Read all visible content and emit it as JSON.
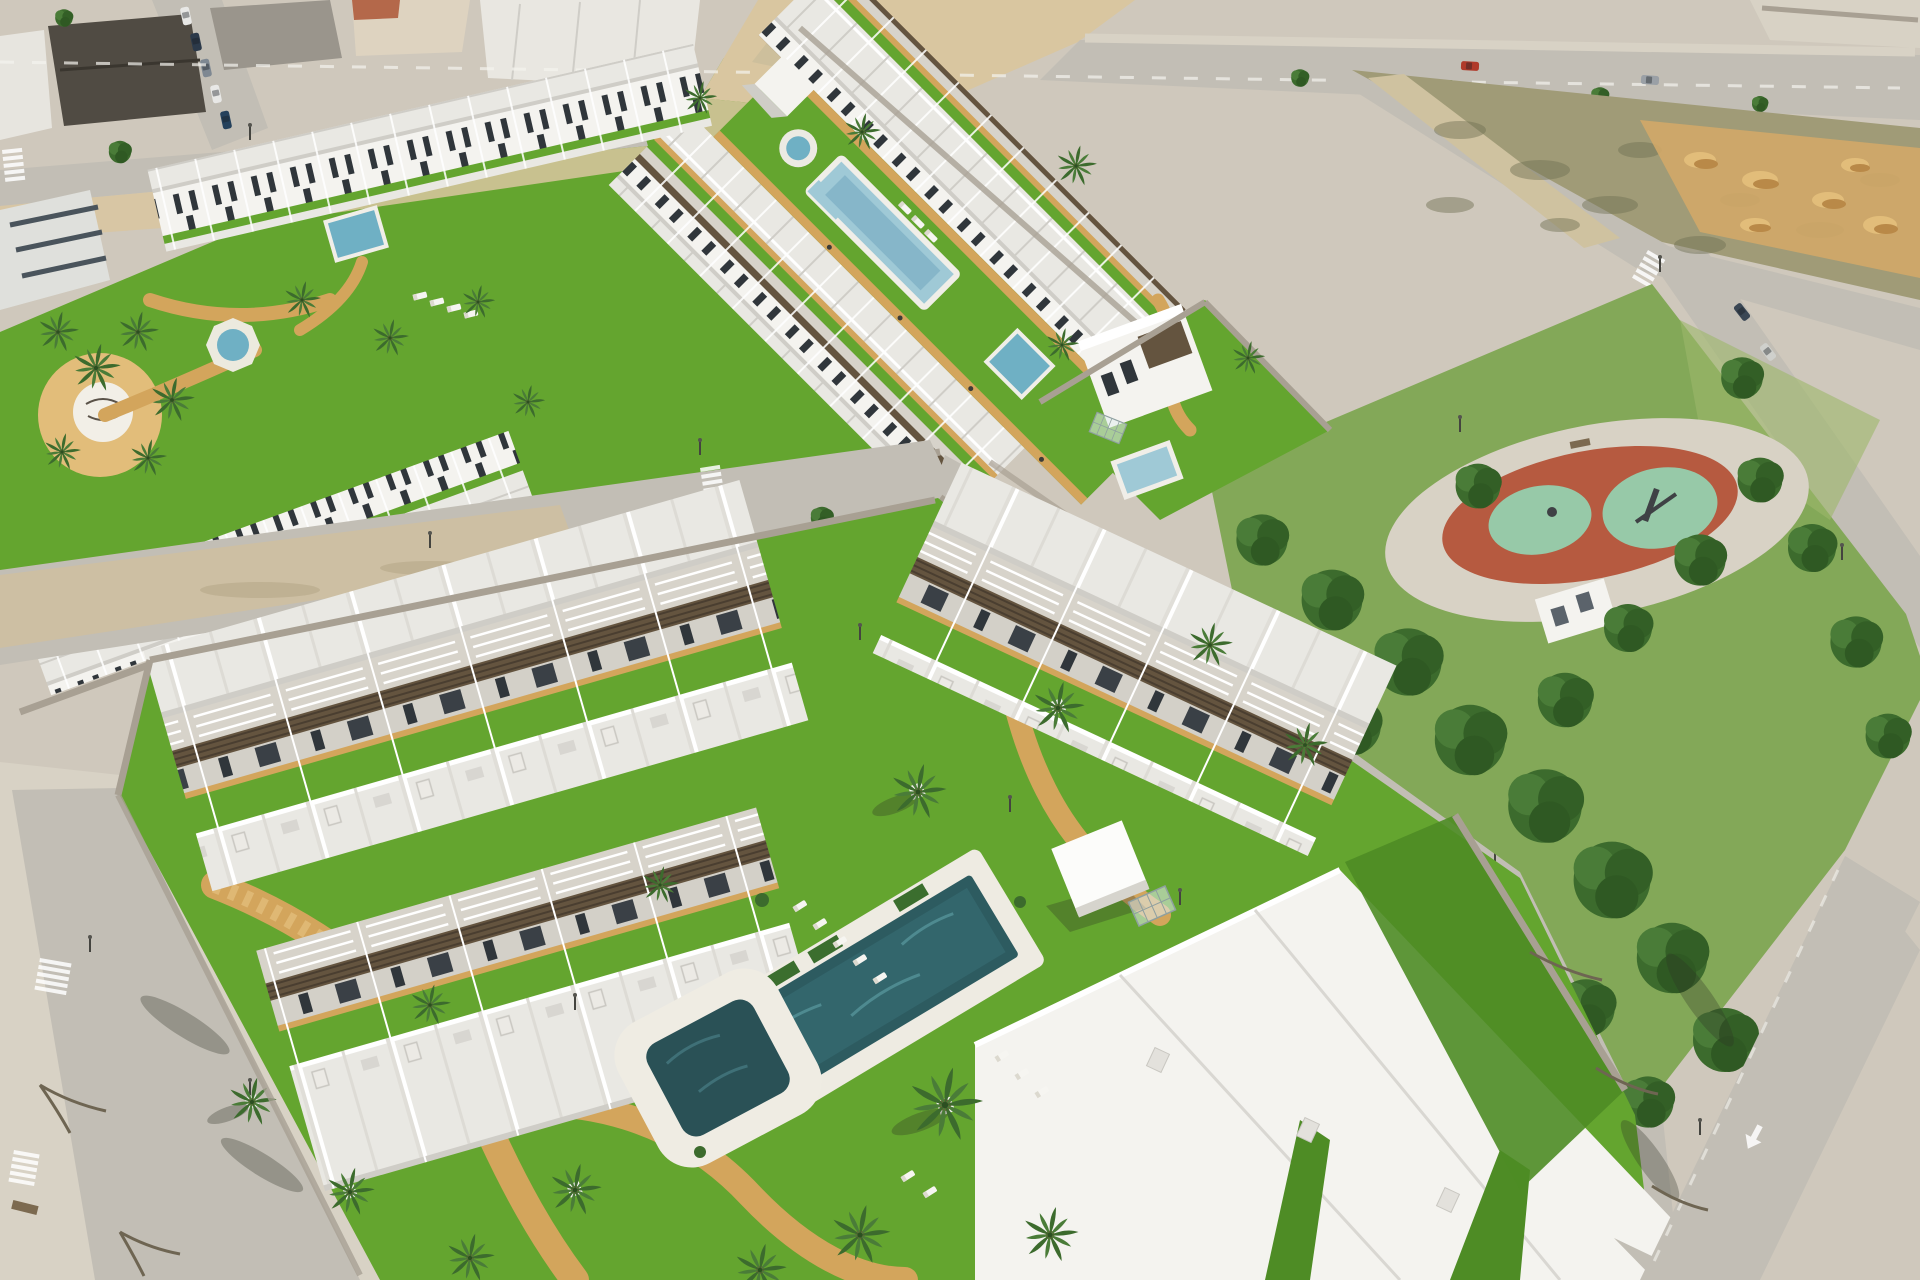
{
  "meta": {
    "description": "Aerial 3D render of a new coastal residential development: rows of white flat-roofed townhouses with wooden pergolas around landscaped courtyards with swimming pools and palm trees, an older urban block with parked cars at the top left, a sandy vacant plot with dirt mounds at the top right, a public park with dense pines and a red oval playground on the right, and light asphalt roads with zebra crossings winding between the blocks."
  },
  "scene": {
    "colors": {
      "white": "#f4f3ef",
      "roofLight": "#e9e8e3",
      "roofShade": "#cfcdc7",
      "window": "#30363b",
      "pergola": "#64543f",
      "patio": "#d7d3ca",
      "grass": "#64a52f",
      "grassDark": "#4e8c25",
      "parkGrass": "#83a858",
      "sandPath": "#d3a55c",
      "sandLight": "#e2bd7a",
      "dirt": "#d9c6a0",
      "scrub": "#a09b77",
      "scrubDark": "#6f6f52",
      "road": "#c2beb5",
      "sidewalk": "#d8d2c5",
      "ground": "#cfc8bc",
      "poolDark": "#2d5b60",
      "poolMid": "#6fb0c4",
      "poolLight": "#9fc9d6",
      "treeDark": "#3c6b2d",
      "treeMid": "#4a7c38",
      "playRed": "#b65a40",
      "playGreen": "#97c9a8",
      "wallStone": "#a8a093",
      "carRed": "#b03a2a",
      "trunk": "#7a5c3a"
    },
    "areas": [
      {
        "id": "urban-district",
        "label": "existing town block with parked cars"
      },
      {
        "id": "upper-residential-rows",
        "label": "two rows of white townhouses"
      },
      {
        "id": "central-pool-strip",
        "label": "long lawn strip with fountain, lap pool and kids pool"
      },
      {
        "id": "left-residential-rows",
        "label": "townhouse rows with garden, octagonal fountain and logo plaza"
      },
      {
        "id": "corner-villa",
        "label": "detached two-storey villa with private pool"
      },
      {
        "id": "vacant-plot",
        "label": "fenced scrub plot with sand piles"
      },
      {
        "id": "public-park",
        "label": "pine park with red oval playground"
      },
      {
        "id": "foreground-apartments",
        "label": "large apartment blocks around main courtyard"
      },
      {
        "id": "central-courtyard",
        "label": "courtyard with main pool, plunge pool, loungers, palms and golden paths"
      },
      {
        "id": "roads",
        "label": "light asphalt streets with zebra crossings, lamp posts and a white lane arrow"
      }
    ],
    "features": {
      "pools": [
        "strip-lap-pool",
        "strip-kids-pool",
        "strip-round-fountain",
        "garden-octagon-fountain",
        "garden-small-pool",
        "villa-pool",
        "main-courtyard-pool",
        "plunge-pool"
      ],
      "vehicles": [
        "red-car-on-avenue",
        "parked-cars-town-street",
        "parked-cars-side-road",
        "white-car-on-dirt"
      ],
      "street_furniture": [
        "lamp-posts",
        "benches",
        "zebra-crossings",
        "lane-arrow",
        "glass-pergolas",
        "pool-kiosk-cube",
        "sun-loungers"
      ]
    }
  }
}
